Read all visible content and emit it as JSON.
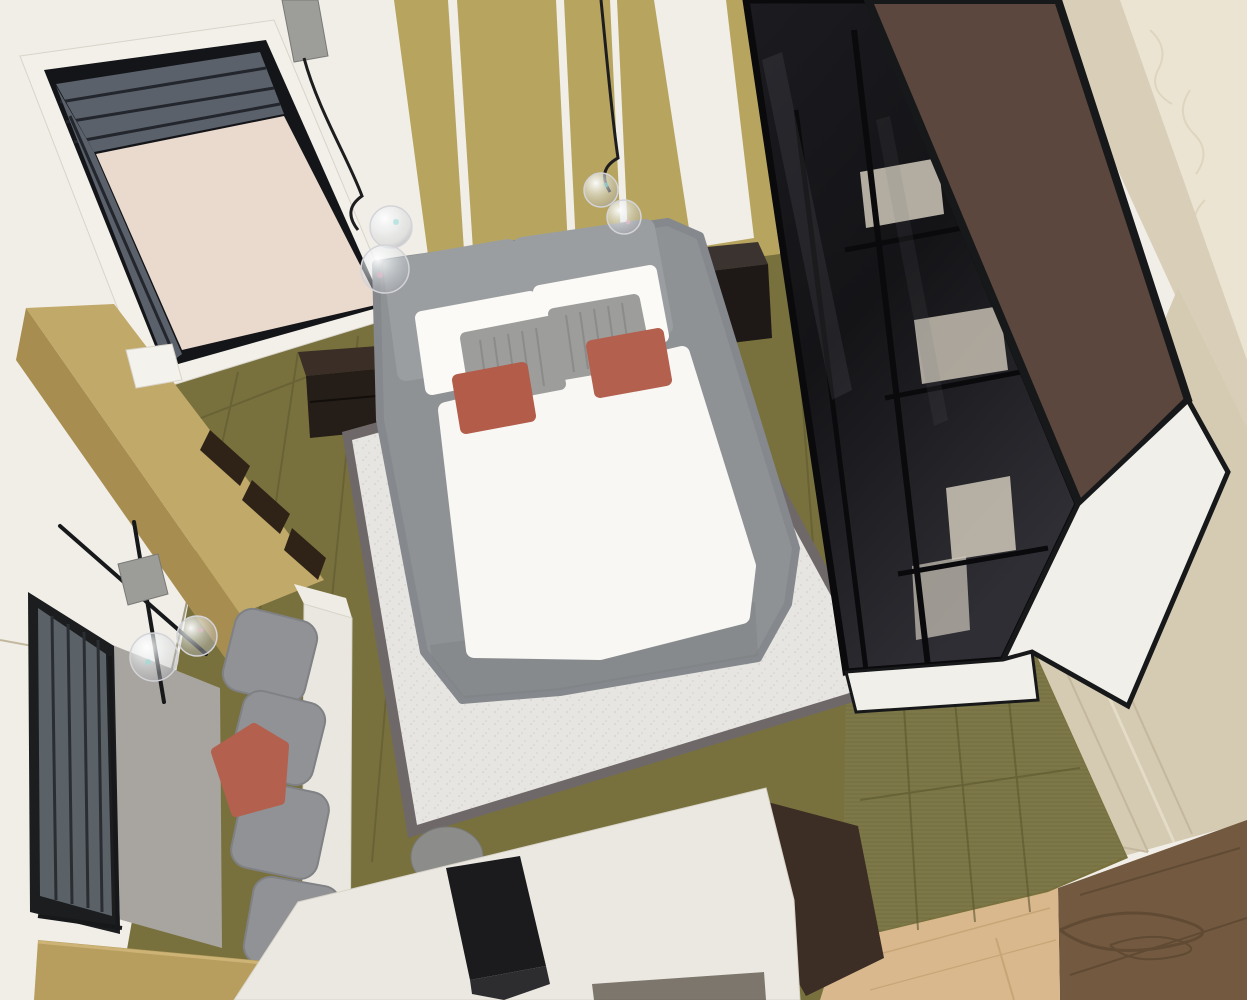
{
  "scene": {
    "type": "photograph",
    "view": "high-angle top-down view",
    "description": "Top-down photograph of a miniature modern bedroom interior scale model. A gray upholstered double bed with white pillows, gray ribbed cushions and two terracotta accent pillows sits on a white rug with dark border over an olive wood plank floor. A black-framed glass wardrobe with white towel stacks stands on the right, its brown top panel visible. A doorway with dark louvered panels opens at the top left. A tan floating shelf, a wall lamp with glass bubble shades, a dark louvered window, and a gray modular sofa with a terracotta pillow line the left wall. A white desk with a black laptop, gray stool and dark brown cabinet crosses the bottom. Two pendant lights with iridescent glass bubble shades hang over the bed. The model sits on a real hardwood floor visible in the bottom-right corner."
  },
  "palette": {
    "wallWhite": "#f1eee8",
    "doorWhite": "#f3f0ea",
    "frameBlack": "#141518",
    "louver": "#5a616b",
    "louverLine": "#23262c",
    "doorPink": "#ead9cd",
    "gold": "#b7a55f",
    "extCream": "#ece4d2",
    "creamLine": "#dcd2ba",
    "beigeBand": "#d9cfb9",
    "beigeWall": "#d5cab2",
    "beigeMold": "#c3b89e",
    "beigeMoldLight": "#e4dcc6",
    "woodDark": "#72593f",
    "woodGrain": "#59442f",
    "woodLight": "#d8b88c",
    "woodLightLine": "#c4a172",
    "olive": "#78713e",
    "olive2": "#7d7847",
    "oliveSeam": "#5c562f",
    "grayPanel": "#a8a5a0",
    "winFrame": "#1b1d1f",
    "winLouver": "#5a6167",
    "winSlat": "#2a2e33",
    "rodBlack": "#17181a",
    "tanTop": "#c1a969",
    "tanFront": "#a78d50",
    "slotDark": "#2e2316",
    "trayWhite": "#f4f2ec",
    "lampCube": "#9c9c98",
    "nightTop": "#3b3330",
    "nightFront": "#1e1916",
    "night2Top": "#3a2e26",
    "night2Front": "#251d17",
    "drawerLine": "#120e0b",
    "rugBorder": "#6f6869",
    "rugWhite": "#e6e5e1",
    "towel": "#cfc8ba",
    "shelfLine": "#0a0a0c",
    "brownTop": "#5c473e",
    "wardWhite": "#f1efe9",
    "reflect": "#6a6a72",
    "bedGray": "#8f9295",
    "bedEdge": "#85888c",
    "bedShadow": "#7e8184",
    "mattress": "#f8f7f4",
    "mattressEdge": "#e3e1db",
    "cushion": "#9b9ea1",
    "pillow": "#fbfaf7",
    "ribbed": "#9d9d9b",
    "ribLine": "#8b8b89",
    "terracotta": "#b25c49",
    "terracotta2": "#b4604e",
    "pendantGray": "#9d9d99",
    "wire": "#1d1d1f",
    "glassStroke": "#d4d4d8",
    "speckCyan": "#9adcd8",
    "speckPink": "#e9bcd0",
    "sofaGray": "#909295",
    "sofaEdge": "#7f8184",
    "sofaBase": "#eae7e0",
    "sofaArm": "#efece6",
    "tanBox": "#b79e5e",
    "tanBoxEdge": "#cdb476",
    "stool": "#8c8c8a",
    "stoolEdge": "#797977",
    "cabinet": "#3c2d25",
    "deskWhite": "#ebe8e1",
    "deskEdge": "#d8d4ca",
    "deskShadow": "#33291f",
    "laptop": "#1b1b1d",
    "laptopBase": "#2d2d30"
  },
  "objects": [
    {
      "id": "doorway",
      "label": "Open doorway with dark louvered panels and pink-beige door"
    },
    {
      "id": "headboard-wall",
      "label": "Olive-gold slatted headboard wall with white stripes"
    },
    {
      "id": "pendant-lights",
      "label": "Two pendant lights with iridescent glass bubble shades"
    },
    {
      "id": "bed",
      "label": "Gray upholstered double bed with white mattress"
    },
    {
      "id": "pillows",
      "label": "White pillows, gray ribbed cushions, terracotta accent pillows"
    },
    {
      "id": "nightstands",
      "label": "Two dark brown nightstands"
    },
    {
      "id": "rug",
      "label": "White area rug with dark gray border"
    },
    {
      "id": "wardrobe",
      "label": "Black glass-front wardrobe with towel stacks and brown top"
    },
    {
      "id": "floating-shelf",
      "label": "Tan wall-mounted shelf with compartments"
    },
    {
      "id": "wall-lamp",
      "label": "Wall lamp with black rods, concrete cube and glass bubbles"
    },
    {
      "id": "window-blind",
      "label": "Dark louvered window panel"
    },
    {
      "id": "sofa",
      "label": "Gray modular sofa with terracotta pillow"
    },
    {
      "id": "desk",
      "label": "White desk with black laptop, gray stool and brown cabinet"
    },
    {
      "id": "floors",
      "label": "Olive plank interior floor; real hardwood floor outside model"
    }
  ]
}
